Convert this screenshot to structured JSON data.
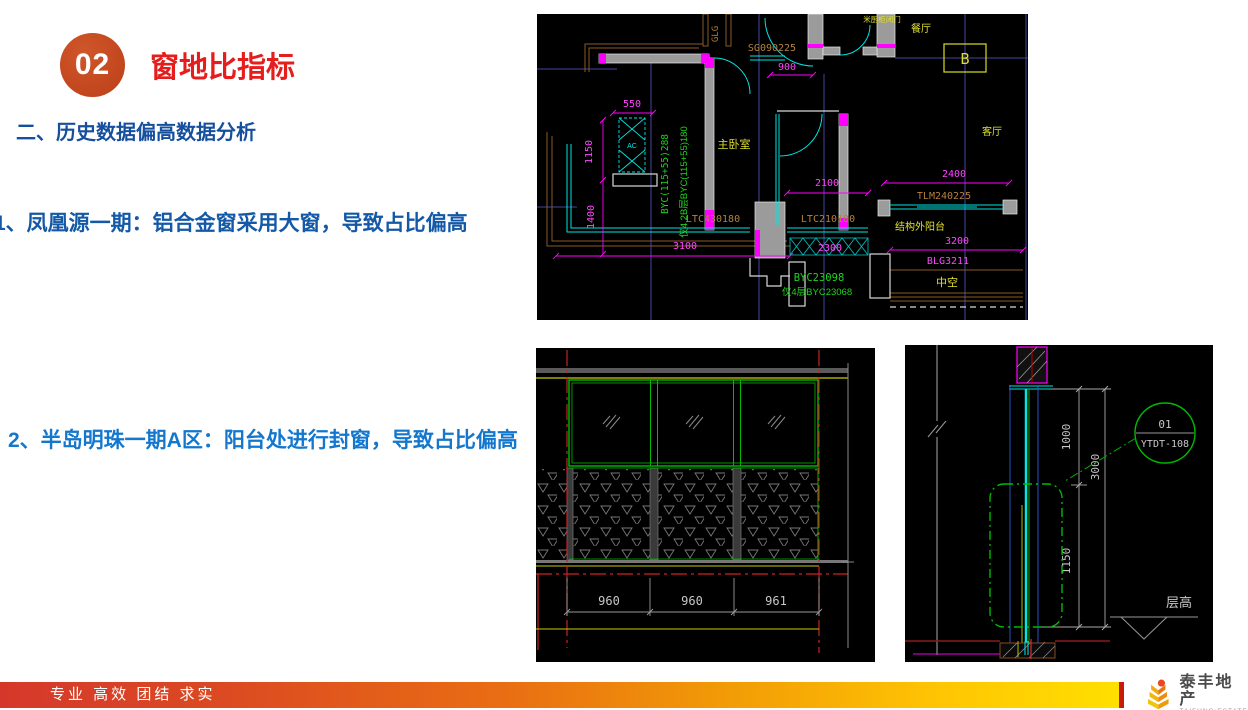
{
  "slide": {
    "badge_number": "02",
    "title": "窗地比指标",
    "section_heading": "二、历史数据偏高数据分析",
    "item1": "1、凤凰源一期：铝合金窗采用大窗，导致占比偏高",
    "item2": "2、半岛明珠一期A区：阳台处进行封窗，导致占比偏高"
  },
  "footer": {
    "slogan": "专业 高效 团结 求实",
    "logo_cn": "泰丰地产",
    "logo_en": "TAIFUNG ESTATE"
  },
  "colors": {
    "title_red": "#e61d1d",
    "badge_orange": "#c7441f",
    "heading_blue": "#164f9e",
    "item_blue": "#1377ce",
    "footer_gradient_start": "#d5382b",
    "footer_gradient_end": "#ffe000"
  },
  "cad_plan": {
    "rooms": {
      "master_bedroom": "主卧室",
      "dining": "餐厅",
      "living": "客厅",
      "balcony": "结构外阳台",
      "void": "中空",
      "grid_ref": "B"
    },
    "annotations": {
      "door_note": "米厨柜闭门",
      "sg": "SG090225",
      "glg": "GLG",
      "byc_v1": "BYC(115+55)288",
      "byc_v2": "仅4,2B层BYC(115+55)180",
      "ltc1": "LTC430180",
      "ltc2": "LTC210180",
      "tlm": "TLM240225",
      "blg": "BLG3211",
      "byc1": "BYC23098",
      "byc2": "仅4层BYC23068",
      "ac": "AC"
    },
    "dims": {
      "d550": "550",
      "d900": "900",
      "d1150": "1150",
      "d1400": "1400",
      "d2100": "2100",
      "d2300": "2300",
      "d2400": "2400",
      "d3100": "3100",
      "d3200": "3200"
    }
  },
  "cad_elevation": {
    "dims": [
      "960",
      "960",
      "961"
    ]
  },
  "cad_section": {
    "detail_no": "01",
    "detail_code": "YTDT-108",
    "level_label": "层高",
    "dims": {
      "d1000": "1000",
      "d3000": "3000",
      "d1150": "1150"
    }
  }
}
